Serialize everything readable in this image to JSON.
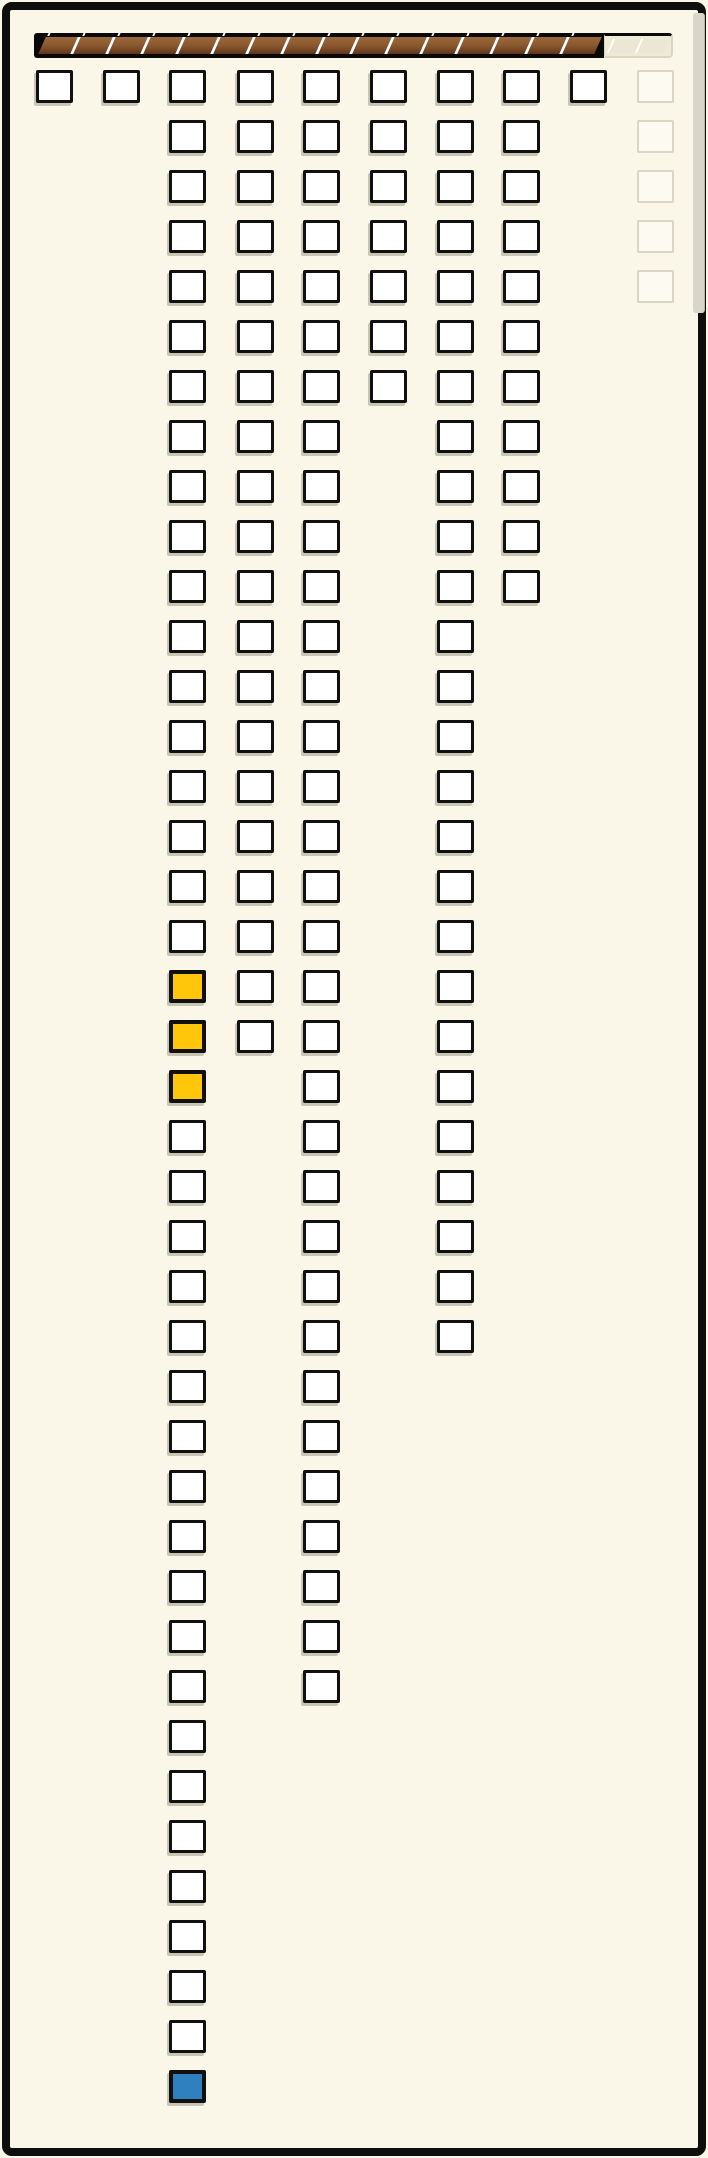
{
  "window": {
    "background_color": "#FAF7E9",
    "frame_color": "#0E0E0C"
  },
  "progress_bar": {
    "segments_total": 18,
    "segments_filled": 16,
    "segments_remaining": 2,
    "filled_color": "#8B5A30",
    "filled_shade_color": "#5E3418",
    "track_color": "#0A0908",
    "separator_color": "#FFFFFF",
    "remaining_fill": "#EFE9D8",
    "remaining_outline": "#DBD6C4"
  },
  "board": {
    "cell_states_legend": {
      "n": "empty-checkbox",
      "y": "yellow-filled",
      "b": "blue-filled",
      "g": "ghost-placeholder"
    },
    "counts_per_column": [
      1,
      1,
      41,
      20,
      33,
      7,
      26,
      11,
      1,
      5
    ],
    "yellow_cells": [
      {
        "column": 3,
        "rows": [
          19,
          20,
          21
        ]
      }
    ],
    "blue_cells": [
      {
        "column": 3,
        "row": 41
      }
    ],
    "ghost_columns": [
      10
    ],
    "columns": [
      {
        "name": "column-1",
        "cells": [
          "n"
        ]
      },
      {
        "name": "column-2",
        "cells": [
          "n"
        ]
      },
      {
        "name": "column-3",
        "cells": [
          "n",
          "n",
          "n",
          "n",
          "n",
          "n",
          "n",
          "n",
          "n",
          "n",
          "n",
          "n",
          "n",
          "n",
          "n",
          "n",
          "n",
          "n",
          "y",
          "y",
          "y",
          "n",
          "n",
          "n",
          "n",
          "n",
          "n",
          "n",
          "n",
          "n",
          "n",
          "n",
          "n",
          "n",
          "n",
          "n",
          "n",
          "n",
          "n",
          "n",
          "b"
        ]
      },
      {
        "name": "column-4",
        "cells": [
          "n",
          "n",
          "n",
          "n",
          "n",
          "n",
          "n",
          "n",
          "n",
          "n",
          "n",
          "n",
          "n",
          "n",
          "n",
          "n",
          "n",
          "n",
          "n",
          "n"
        ]
      },
      {
        "name": "column-5",
        "cells": [
          "n",
          "n",
          "n",
          "n",
          "n",
          "n",
          "n",
          "n",
          "n",
          "n",
          "n",
          "n",
          "n",
          "n",
          "n",
          "n",
          "n",
          "n",
          "n",
          "n",
          "n",
          "n",
          "n",
          "n",
          "n",
          "n",
          "n",
          "n",
          "n",
          "n",
          "n",
          "n",
          "n"
        ]
      },
      {
        "name": "column-6",
        "cells": [
          "n",
          "n",
          "n",
          "n",
          "n",
          "n",
          "n"
        ]
      },
      {
        "name": "column-7",
        "cells": [
          "n",
          "n",
          "n",
          "n",
          "n",
          "n",
          "n",
          "n",
          "n",
          "n",
          "n",
          "n",
          "n",
          "n",
          "n",
          "n",
          "n",
          "n",
          "n",
          "n",
          "n",
          "n",
          "n",
          "n",
          "n",
          "n"
        ]
      },
      {
        "name": "column-8",
        "cells": [
          "n",
          "n",
          "n",
          "n",
          "n",
          "n",
          "n",
          "n",
          "n",
          "n",
          "n"
        ]
      },
      {
        "name": "column-9",
        "cells": [
          "n"
        ]
      },
      {
        "name": "column-10",
        "cells": [
          "g",
          "g",
          "g",
          "g",
          "g"
        ]
      }
    ]
  },
  "cell_colors": {
    "fill": "#FFFFFF",
    "border": "#101010",
    "yellow": "#FFC60A",
    "blue": "#2E80BE",
    "ghost_fill": "#FCFAF1",
    "ghost_outline": "#DBD6C4",
    "shadow": "#C9C5B4"
  },
  "scrollbar": {
    "thumb_color": "#D9D5C8"
  }
}
